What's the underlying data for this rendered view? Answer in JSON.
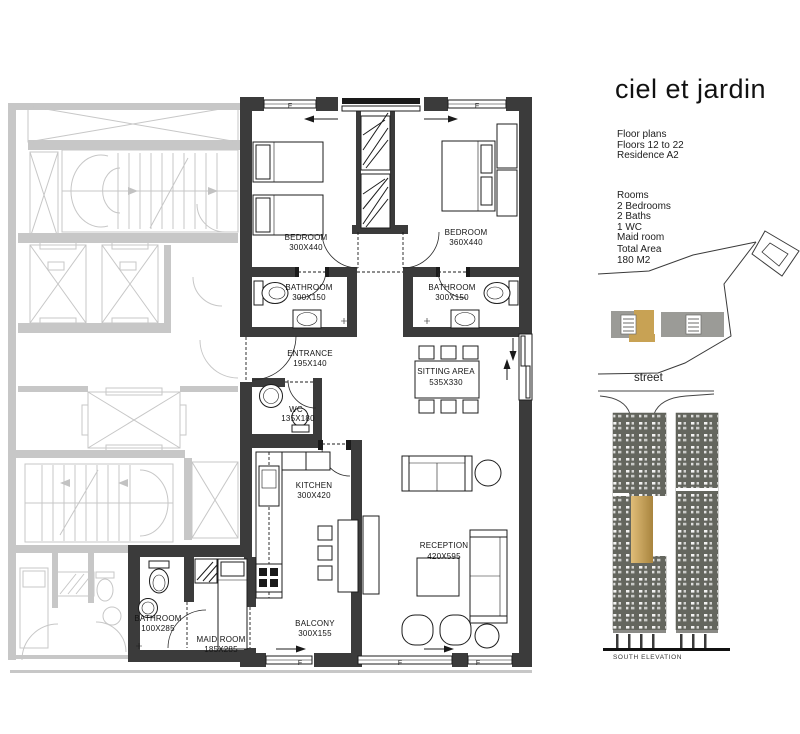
{
  "panel": {
    "title": "ciel et jardin",
    "floor_info": [
      "Floor plans",
      "Floors  12 to 22",
      "Residence A2"
    ],
    "rooms_info": [
      "Rooms",
      "2 Bedrooms",
      "2 Baths",
      "1 WC",
      "Maid room"
    ],
    "total_area": [
      "Total Area",
      "180 M2"
    ],
    "street_label": "street",
    "elevation_label": "SOUTH ELEVATION"
  },
  "plan": {
    "window_label": "F",
    "rooms": [
      {
        "name": "BEDROOM",
        "dims": "300X440"
      },
      {
        "name": "BEDROOM",
        "dims": "360X440"
      },
      {
        "name": "BATHROOM",
        "dims": "300X150"
      },
      {
        "name": "BATHROOM",
        "dims": "300X150"
      },
      {
        "name": "ENTRANCE",
        "dims": "195X140"
      },
      {
        "name": "WC",
        "dims": "135X180"
      },
      {
        "name": "SITTING AREA",
        "dims": "535X330"
      },
      {
        "name": "KITCHEN",
        "dims": "300X420"
      },
      {
        "name": "RECEPTION",
        "dims": "420X595"
      },
      {
        "name": "BATHROOM",
        "dims": "100X285"
      },
      {
        "name": "MAID ROOM",
        "dims": "185X285"
      },
      {
        "name": "BALCONY",
        "dims": "300X155"
      }
    ]
  },
  "colors": {
    "accent_gold": "#c8a254",
    "wall_dark": "#3b3b3b",
    "context_gray": "#c7c7c7",
    "site_block_gray": "#9b9b97",
    "elevation_gray": "#64665e"
  }
}
